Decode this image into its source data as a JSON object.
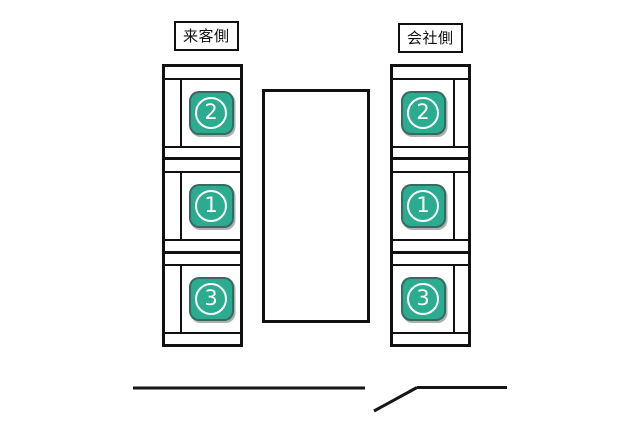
{
  "page": {
    "background": "#ffffff",
    "line_color": "#111111"
  },
  "badge": {
    "fill": "#2bab90",
    "text_color": "#ffffff"
  },
  "visitor_section": {
    "label": "来客側",
    "seats": [
      {
        "number": "2"
      },
      {
        "number": "1"
      },
      {
        "number": "3"
      }
    ]
  },
  "company_section": {
    "label": "会社側",
    "seats": [
      {
        "number": "2"
      },
      {
        "number": "1"
      },
      {
        "number": "3"
      }
    ]
  }
}
